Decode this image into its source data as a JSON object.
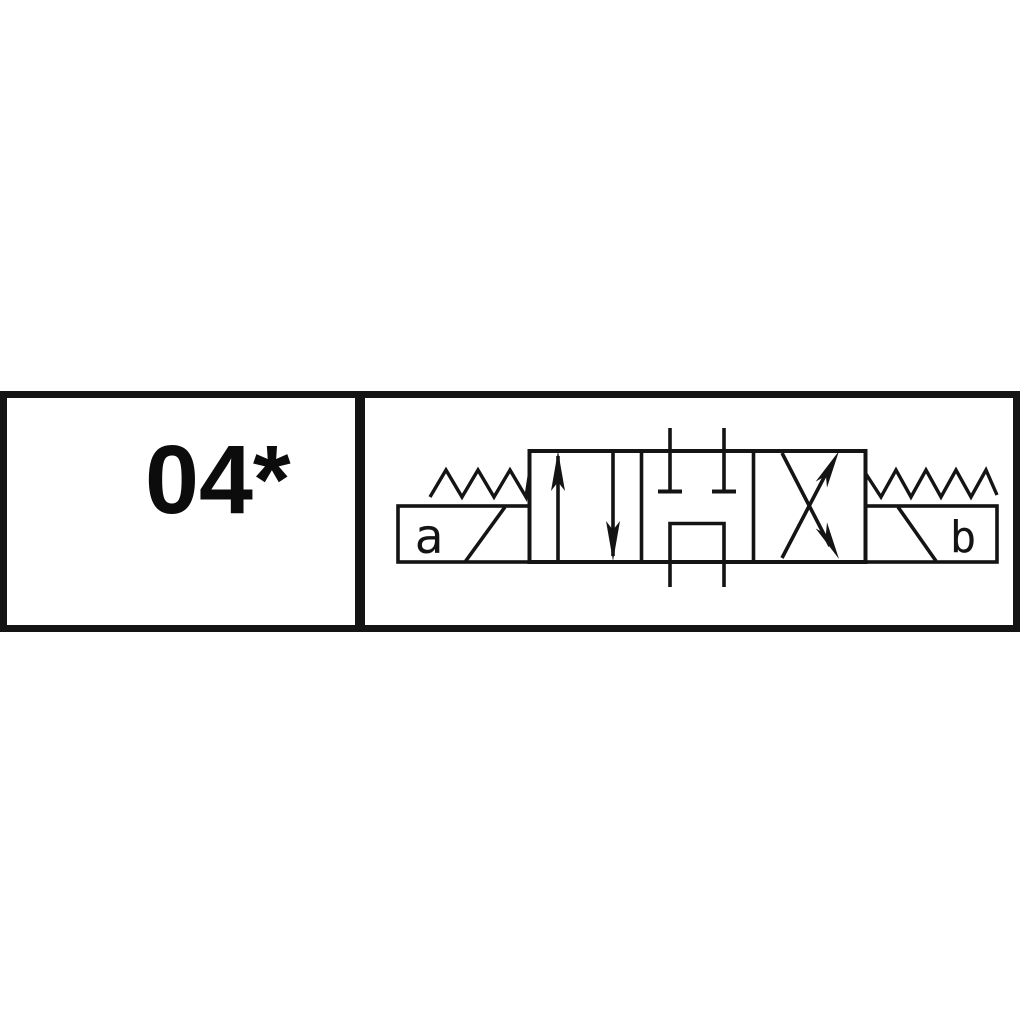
{
  "canvas": {
    "background_color": "#ffffff",
    "line_color": "#141414"
  },
  "table": {
    "code_cell": {
      "label": "04*"
    },
    "symbol_cell": {
      "symbol": "solenoid-spring-centered-4-3-directional-valve-symbol",
      "solenoid_a_label": "a",
      "solenoid_b_label": "b"
    }
  }
}
